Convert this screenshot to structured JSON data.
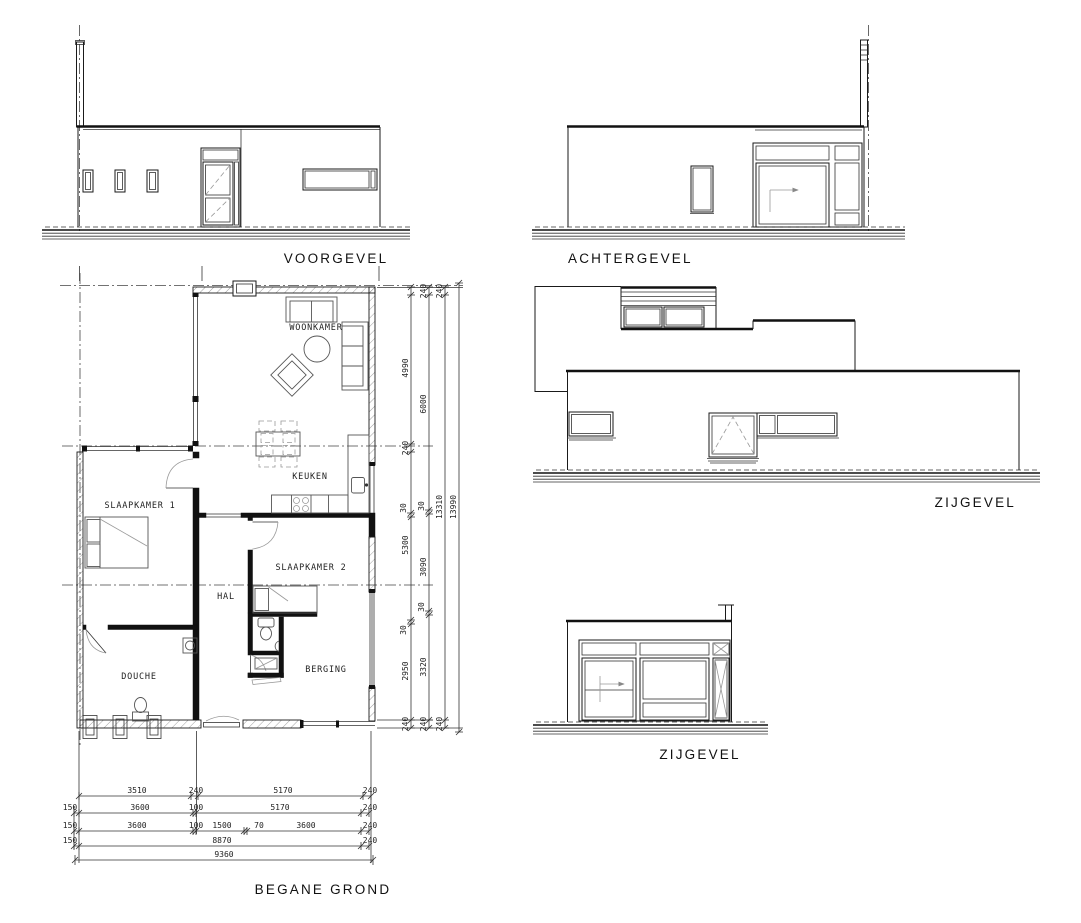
{
  "titles": {
    "voorgevel": "VOORGEVEL",
    "achtergevel": "ACHTERGEVEL",
    "zijgevel_1": "ZIJGEVEL",
    "zijgevel_2": "ZIJGEVEL",
    "begane_grond": "BEGANE  GROND"
  },
  "rooms": {
    "woonkamer": "WOONKAMER",
    "keuken": "KEUKEN",
    "slaapkamer_1": "SLAAPKAMER 1",
    "slaapkamer_2": "SLAAPKAMER 2",
    "hal": "HAL",
    "douche": "DOUCHE",
    "berging": "BERGING"
  },
  "dim_right": {
    "c1": [
      "4990",
      "240",
      "30",
      "5300",
      "30",
      "2950",
      "240"
    ],
    "c2": [
      "240",
      "6000",
      "30",
      "3090",
      "30",
      "3320",
      "240"
    ],
    "c3": [
      "240",
      "13310",
      "240"
    ],
    "c4": [
      "13990"
    ]
  },
  "dim_bottom": {
    "c1": [
      "3510",
      "240",
      "5170",
      "240"
    ],
    "c2": [
      "150",
      "3600",
      "100",
      "5170",
      "240"
    ],
    "c3": [
      "150",
      "3600",
      "100",
      "1500",
      "70",
      "3600",
      "240"
    ],
    "c4": [
      "150",
      "8870",
      "240"
    ],
    "c5": [
      "9360"
    ]
  },
  "colors": {
    "ink": "#1a1a1a",
    "paper": "#ffffff"
  }
}
